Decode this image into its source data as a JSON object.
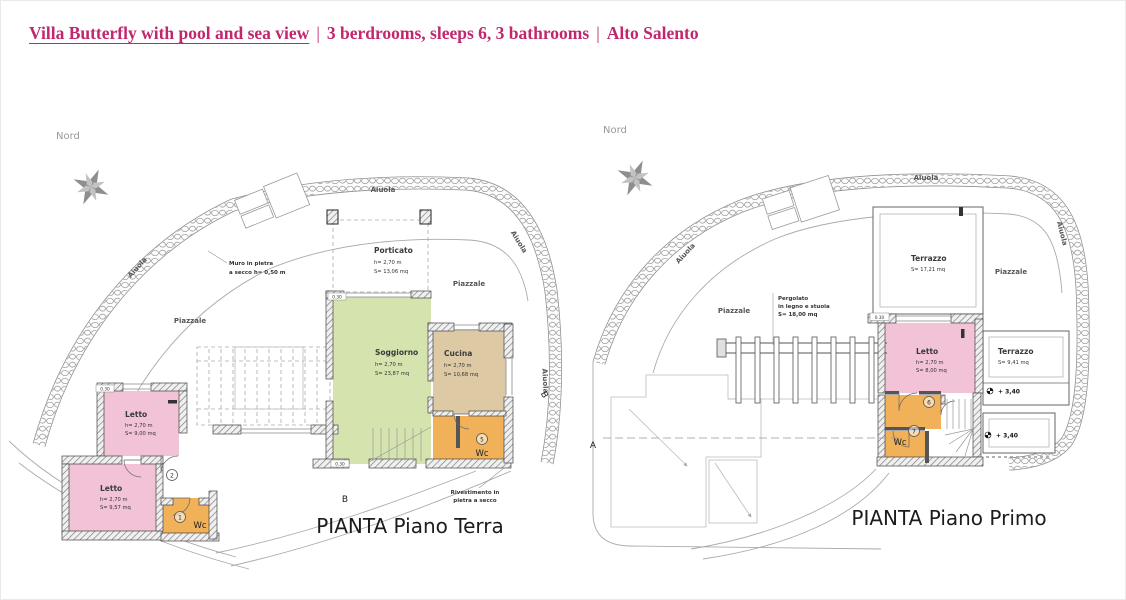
{
  "header": {
    "title_link": "Villa Butterfly with pool and sea view",
    "separator": "|",
    "title_details": "3 berdrooms, sleeps 6, 3 bathrooms",
    "title_area": "Alto Salento"
  },
  "colors": {
    "accent": "#c2266e",
    "room-pink": "#f2c3d7",
    "room-green": "#d5e4ae",
    "room-tan": "#ddcaa5",
    "room-orange": "#f0b159"
  },
  "plan_terra": {
    "title": "PIANTA Piano Terra",
    "north": "Nord",
    "aiuola": "Aiuola",
    "piazzale": "Piazzale",
    "section_b": "B",
    "dim_030": "0.30",
    "muro_note_1": "Muro in pietra",
    "muro_note_2": "a secco h= 0,50 m",
    "rivestimento_note_1": "Rivestimento in",
    "rivestimento_note_2": "pietra a secco",
    "porticato": {
      "name": "Porticato",
      "h": "h= 2,70 m",
      "s": "S= 13,06 mq"
    },
    "soggiorno": {
      "name": "Soggiorno",
      "h": "h= 2,70 m",
      "s": "S= 23,87 mq"
    },
    "cucina": {
      "name": "Cucina",
      "h": "h= 2,70 m",
      "s": "S= 10,68 mq"
    },
    "letto_nord": {
      "name": "Letto",
      "h": "h= 2,70 m",
      "s": "S= 9,00 mq"
    },
    "letto_sud": {
      "name": "Letto",
      "h": "h= 2,70 m",
      "s": "S= 9,57 mq"
    },
    "wc_1": {
      "name": "Wc",
      "num": "1"
    },
    "wc_5": {
      "name": "Wc",
      "num": "5"
    },
    "num_2": "2"
  },
  "plan_primo": {
    "title": "PIANTA Piano Primo",
    "north": "Nord",
    "aiuola": "Aiuola",
    "piazzale": "Piazzale",
    "section_a": "A",
    "dim_030": "0.30",
    "pergolato_note_1": "Pergolato",
    "pergolato_note_2": "in legno e stuoia",
    "pergolato_note_3": "S= 18,00 mq",
    "terrazzo_nord": {
      "name": "Terrazzo",
      "s": "S= 17,21 mq"
    },
    "terrazzo_est": {
      "name": "Terrazzo",
      "s": "S= 9,41 mq"
    },
    "letto": {
      "name": "Letto",
      "h": "h= 2,70 m",
      "s": "S= 8,00 mq"
    },
    "wc_7": {
      "name": "Wc",
      "num": "7"
    },
    "num_6": "6",
    "level": "+ 3,40"
  }
}
